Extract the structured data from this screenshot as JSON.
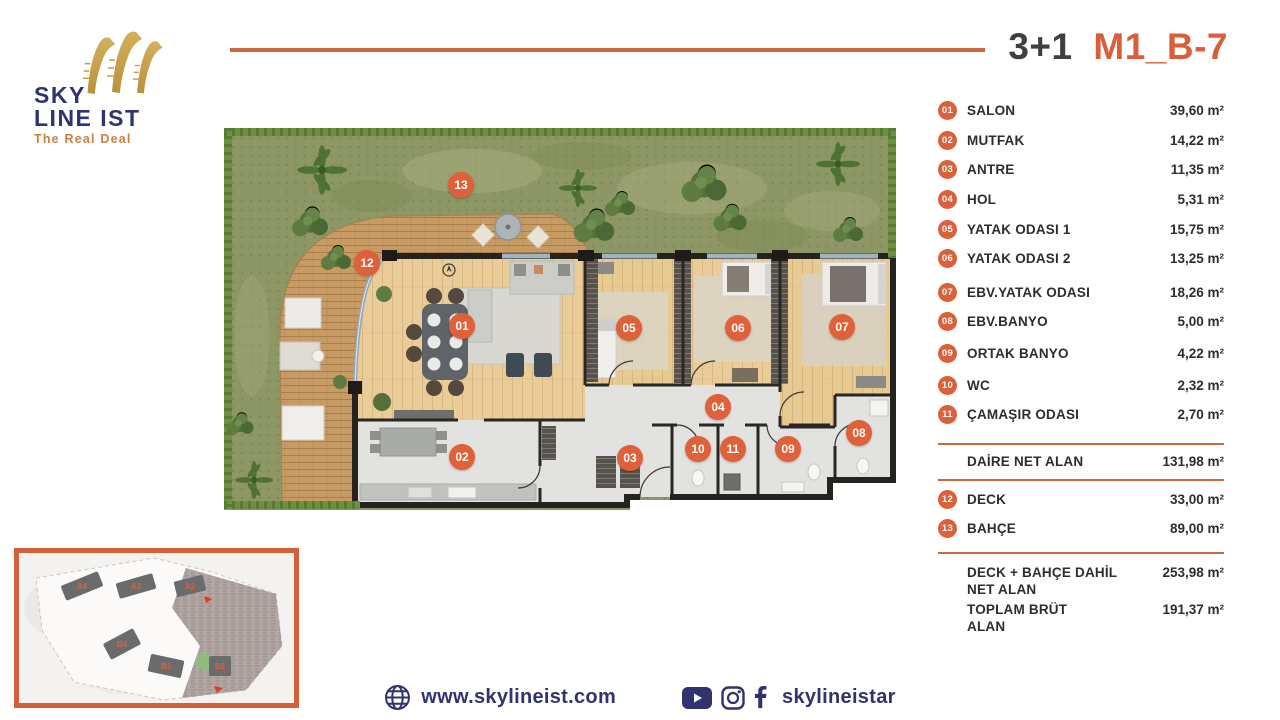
{
  "brand": {
    "line1": "SKY",
    "line2": "LINE IST",
    "tagline": "The Real Deal"
  },
  "title": {
    "plan_type": "3+1",
    "unit_code": "M1_B-7"
  },
  "rooms": [
    {
      "num": "01",
      "label": "SALON",
      "area": "39,60 m²"
    },
    {
      "num": "02",
      "label": "MUTFAK",
      "area": "14,22 m²"
    },
    {
      "num": "03",
      "label": "ANTRE",
      "area": "11,35 m²"
    },
    {
      "num": "04",
      "label": "HOL",
      "area": "5,31 m²"
    },
    {
      "num": "05",
      "label": "YATAK ODASI 1",
      "area": "15,75 m²"
    },
    {
      "num": "06",
      "label": "YATAK ODASI 2",
      "area": "13,25 m²"
    },
    {
      "num": "07",
      "label": "EBV.YATAK ODASI",
      "area": "18,26 m²"
    },
    {
      "num": "08",
      "label": "EBV.BANYO",
      "area": "5,00 m²"
    },
    {
      "num": "09",
      "label": "ORTAK BANYO",
      "area": "4,22 m²"
    },
    {
      "num": "10",
      "label": "WC",
      "area": "2,32 m²"
    },
    {
      "num": "11",
      "label": "ÇAMAŞIR ODASI",
      "area": "2,70 m²"
    }
  ],
  "summary": {
    "net_label": "DAİRE NET ALAN",
    "net_value": "131,98 m²",
    "extras": [
      {
        "num": "12",
        "label": "DECK",
        "area": "33,00 m²"
      },
      {
        "num": "13",
        "label": "BAHÇE",
        "area": "89,00 m²"
      }
    ],
    "totals": [
      {
        "label_line1": "DECK + BAHÇE  DAHİL",
        "label_line2": "NET ALAN",
        "value": "253,98 m²"
      },
      {
        "label_line1": "TOPLAM BRÜT",
        "label_line2": "ALAN",
        "value": "191,37 m²"
      }
    ]
  },
  "plan": {
    "badges": [
      {
        "n": "01"
      },
      {
        "n": "02"
      },
      {
        "n": "03"
      },
      {
        "n": "04"
      },
      {
        "n": "05"
      },
      {
        "n": "06"
      },
      {
        "n": "07"
      },
      {
        "n": "08"
      },
      {
        "n": "09"
      },
      {
        "n": "10"
      },
      {
        "n": "11"
      },
      {
        "n": "12"
      },
      {
        "n": "13"
      }
    ]
  },
  "siteplan": {
    "blocks": [
      {
        "id": "A4"
      },
      {
        "id": "A3"
      },
      {
        "id": "A2"
      },
      {
        "id": "B4"
      },
      {
        "id": "B3"
      },
      {
        "id": "B2"
      }
    ]
  },
  "footer": {
    "website": "www.skylineist.com",
    "handle": "skylineistar"
  },
  "colors": {
    "accent": "#DC603A",
    "navy": "#31336E",
    "gold": "#C39B45",
    "grass": "#8D9765",
    "deck_wood": "#C79B63",
    "floor_wood": "#E9CC97",
    "tile": "#E2E2E0",
    "wall": "#26231F"
  }
}
